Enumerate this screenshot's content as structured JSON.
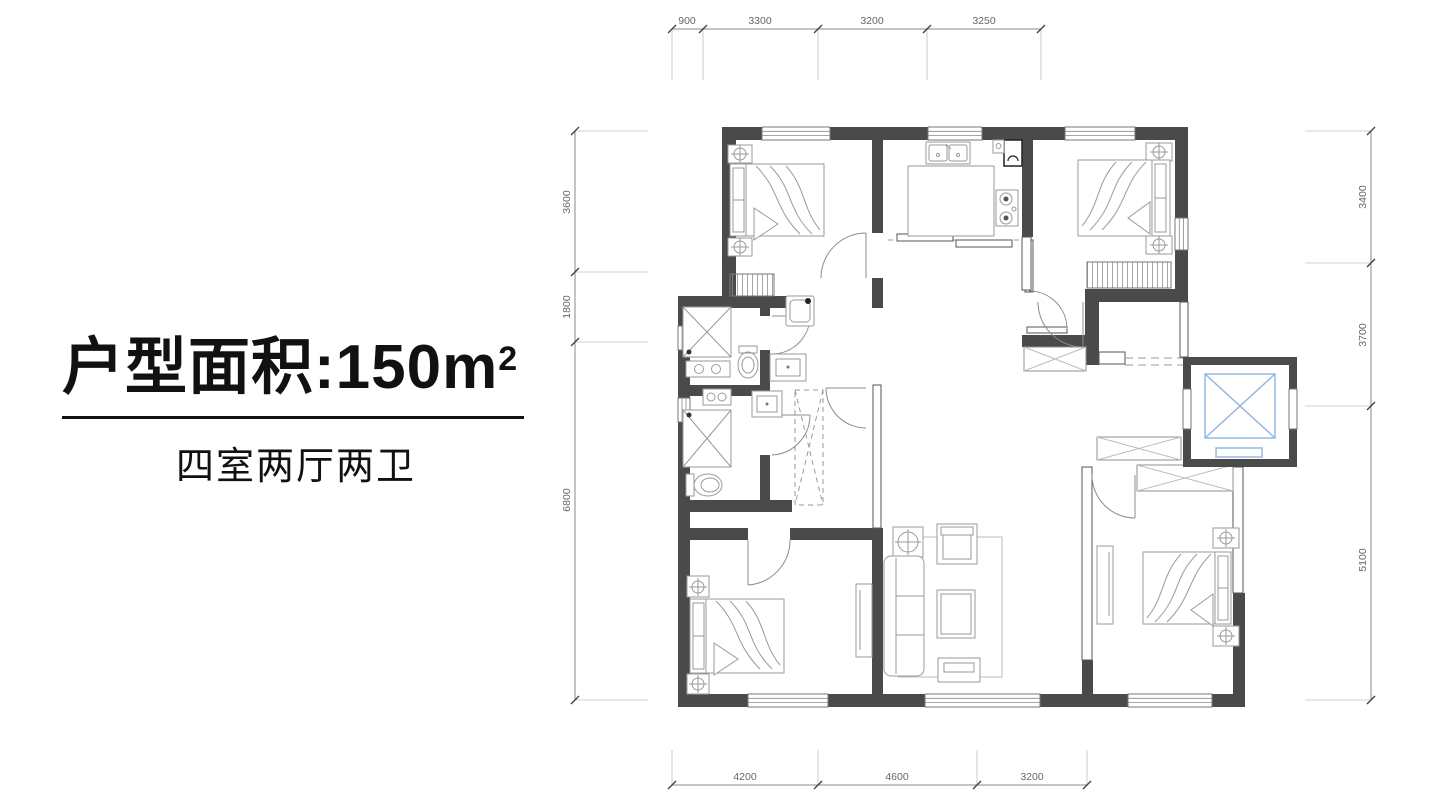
{
  "title": {
    "label": "户型面积:",
    "value": "150",
    "unit_base": "m",
    "unit_exp": "2"
  },
  "subtitle": "四室两厅两卫",
  "dimensions": {
    "top": [
      "900",
      "3300",
      "3200",
      "3250"
    ],
    "left": [
      "3600",
      "1800",
      "6800"
    ],
    "right": [
      "3400",
      "3700",
      "5100"
    ],
    "bottom": [
      "4200",
      "4600",
      "3200"
    ]
  },
  "legend": {
    "wall_color": "#4a4a4a",
    "elevator_color": "#8fb4e0",
    "dimension_text_color": "#666666"
  }
}
